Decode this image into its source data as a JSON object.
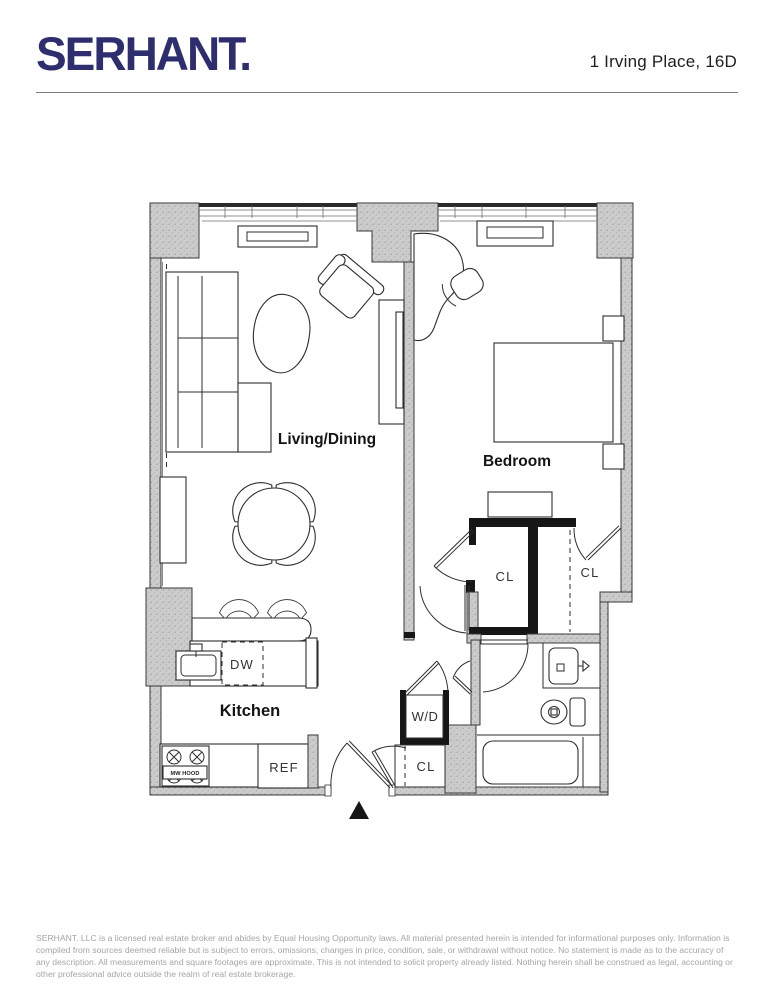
{
  "header": {
    "brand": "SERHANT.",
    "listing_address": "1 Irving Place, 16D"
  },
  "floorplan": {
    "room_labels": {
      "living_dining": "Living/Dining",
      "bedroom": "Bedroom",
      "kitchen": "Kitchen"
    },
    "fixture_labels": {
      "dishwasher": "DW",
      "refrigerator": "REF",
      "washer_dryer": "W/D",
      "closet": "CL",
      "microwave_hood": "MW HOOD"
    }
  },
  "footer": {
    "disclaimer": "SERHANT. LLC is a licensed real estate broker and abides by Equal Housing Opportunity laws. All material presented herein is intended for informational purposes only. Information is compiled from sources deemed reliable but is subject to errors, omissions, changes in price, condition, sale, or withdrawal without notice. No statement is made as to the accuracy of any description. All measurements and square footages are approximate. This is not intended to solicit property already listed. Nothing herein shall be construed as legal, accounting or other professional advice outside the realm of real estate brokerage."
  },
  "colors": {
    "brand_navy": "#2e2e6e",
    "wall_fill": "#cbcbcb",
    "line": "#2e2e2e",
    "muted_text": "#a5a5a5"
  }
}
